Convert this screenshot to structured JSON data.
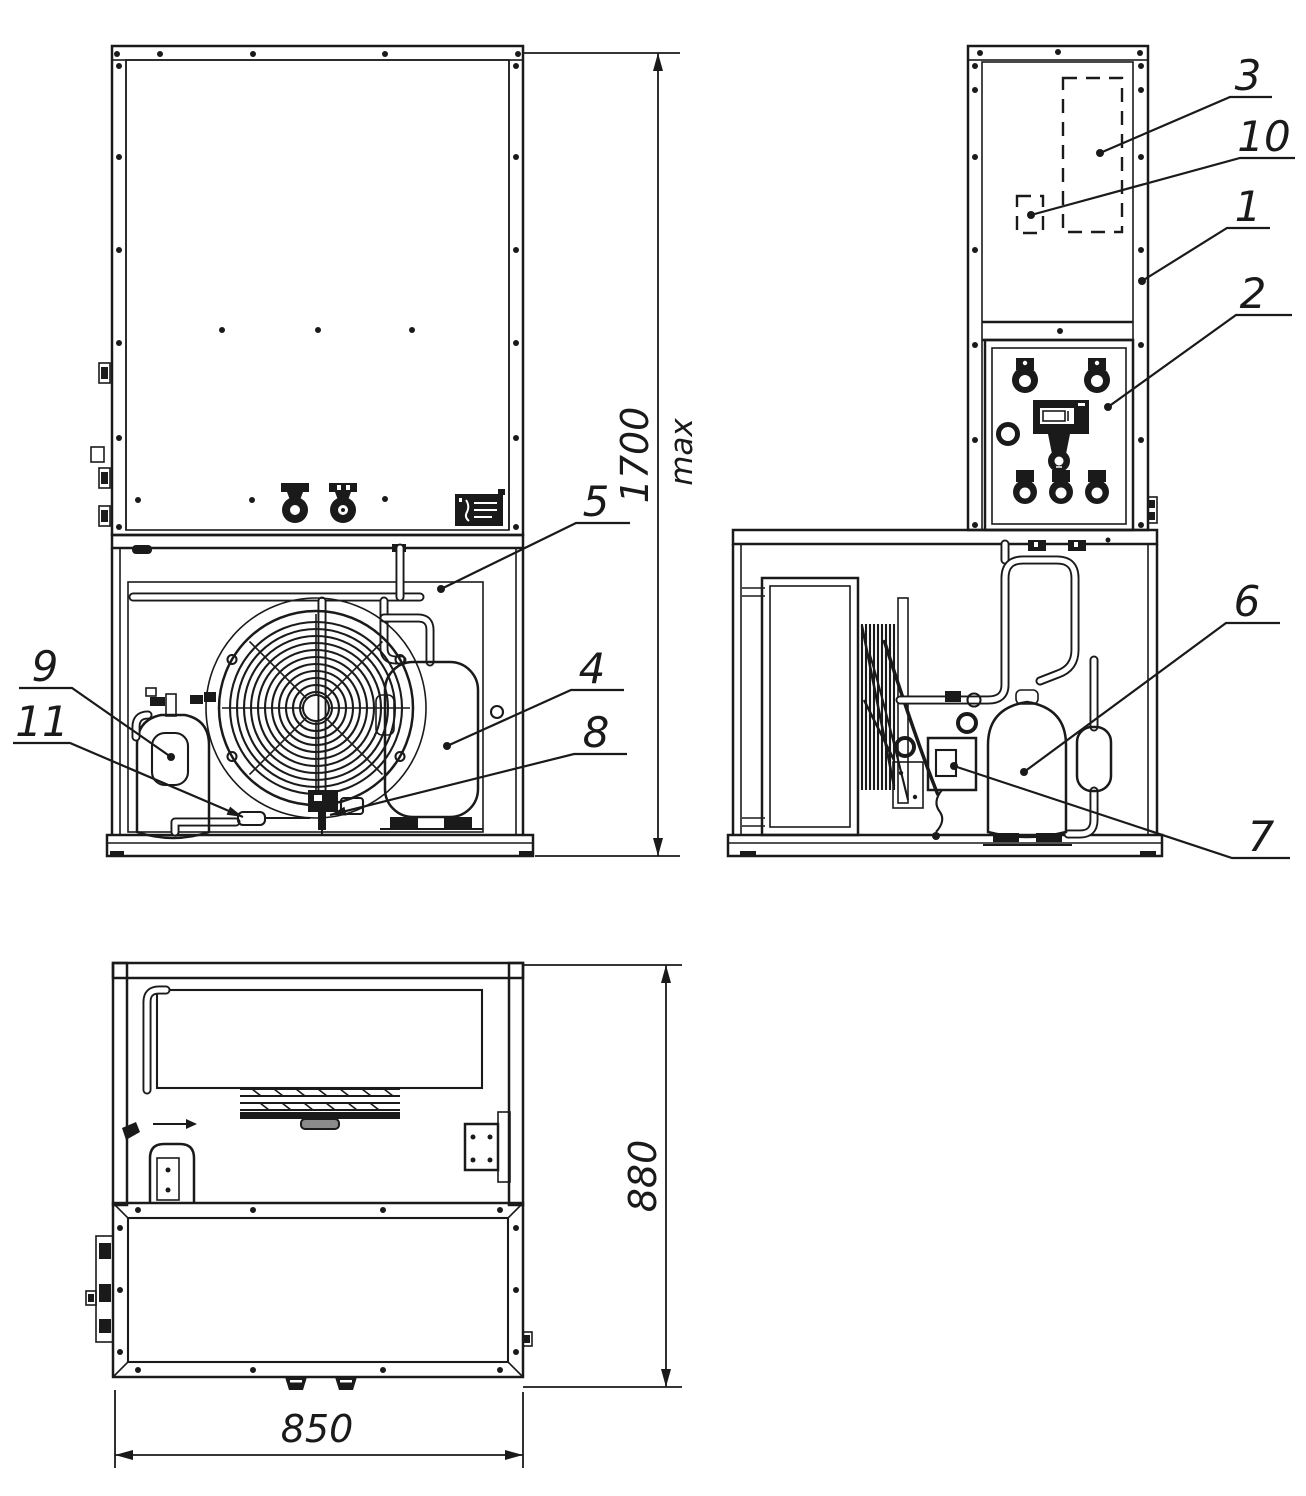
{
  "drawing": {
    "background": "#ffffff",
    "line_color": "#1a1a1a"
  },
  "dimensions": {
    "overall_height": "1700",
    "overall_height_qualifier": "max",
    "overall_width": "850",
    "overall_depth": "880"
  },
  "callouts": {
    "item_1": "1",
    "item_2": "2",
    "item_3": "3",
    "item_4": "4",
    "item_5": "5",
    "item_6": "6",
    "item_7": "7",
    "item_8": "8",
    "item_9": "9",
    "item_10": "10",
    "item_11": "11"
  }
}
